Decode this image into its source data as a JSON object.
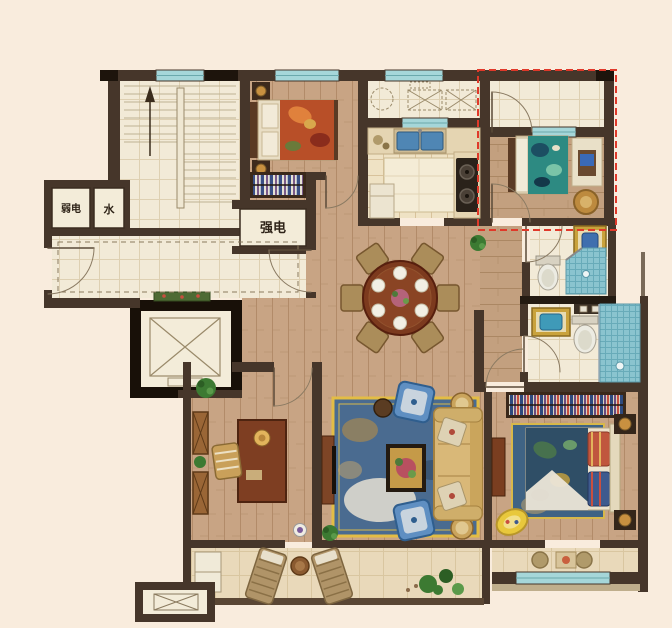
{
  "plan": {
    "type": "apartment-floor-plan",
    "labels": {
      "weak_electric": "弱电",
      "water": "水",
      "strong_electric": "强电"
    },
    "colors": {
      "background": "#f9ecdd",
      "wall": "#46362a",
      "wall_dark": "#1d140c",
      "wood_floor": "#c8a484",
      "tile_floor": "#f2ead7",
      "kitchen_floor": "#efe2c4",
      "balcony_floor": "#e9d9ba",
      "window_glass": "#a5d6d9",
      "shower_tile": "#8ac4cf",
      "gift_area_dash": "#e0392a",
      "rug_blue": "#4a6b90",
      "rug_border_yellow": "#e3bd45",
      "sofa_tan": "#d9b878",
      "armchair_blue": "#5f8fc2",
      "dining_table_wood": "#7c3a1e",
      "plant_green": "#3c7a32",
      "cradle_yellow": "#e8c83c",
      "sink_gold": "#c9a23c",
      "basin_blue": "#3f6fae"
    }
  }
}
